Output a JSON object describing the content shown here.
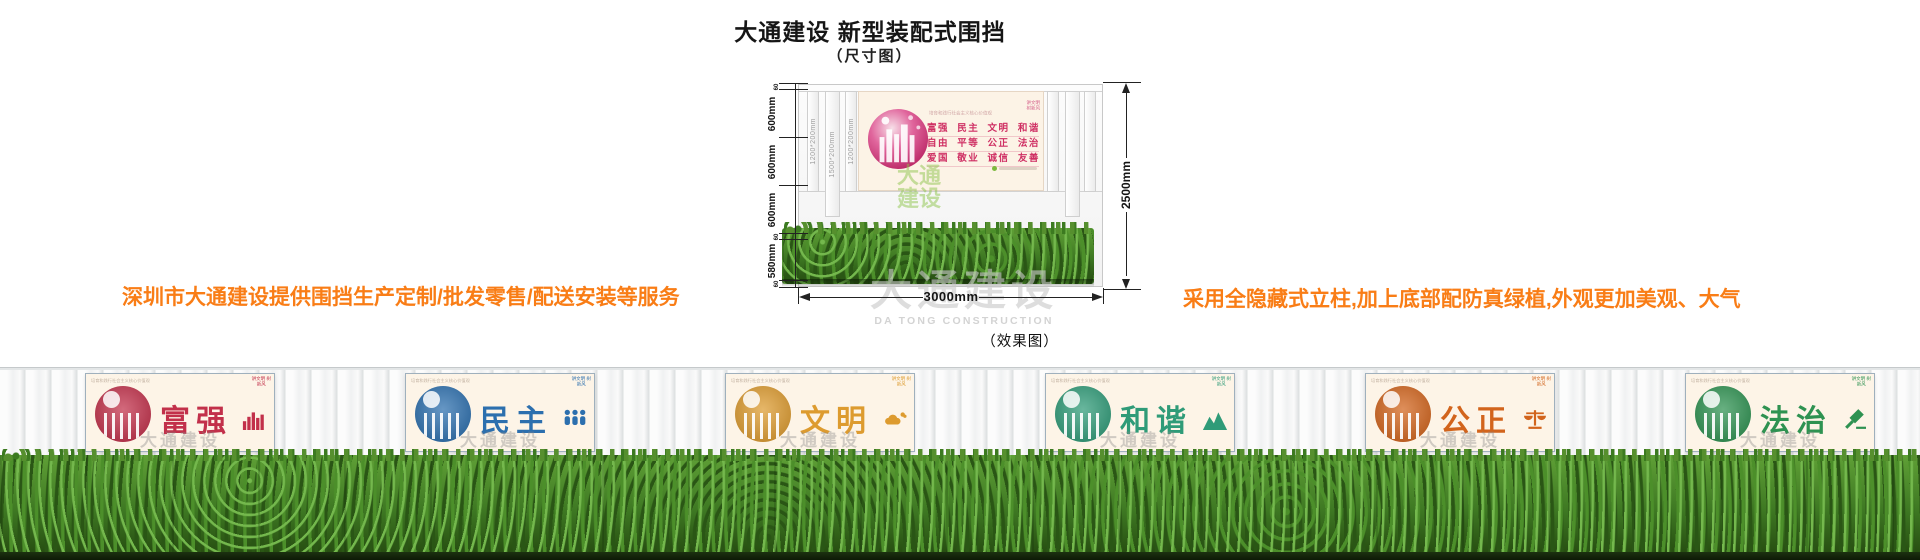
{
  "header": {
    "title": "大通建设 新型装配式围挡",
    "subtitle": "（尺寸图）"
  },
  "notes": {
    "left": "深圳市大通建设提供围挡生产定制/批发零售/配送安装等服务",
    "right": "采用全隐藏式立柱,加上底部配防真绿植,外观更加美观、大气",
    "color": "#f97d16"
  },
  "dimension_diagram": {
    "height_chain": [
      "60",
      "600mm",
      "600mm",
      "600mm",
      "60",
      "580mm",
      "60"
    ],
    "post_labels": [
      "1200*200mm",
      "1500*200mm",
      "1200*200mm"
    ],
    "total_height": "2500mm",
    "total_width": "3000mm",
    "panel": {
      "slogan_header": "培育和践行社会主义核心价值观",
      "corner_lines": [
        "讲文明",
        "树新风"
      ],
      "value_rows": [
        "富强  民主  文明  和谐",
        "自由  平等  公正  法治",
        "爱国  敬业  诚信  友善"
      ],
      "accent_color": "#cf2f63",
      "background_color": "#fcf3e6"
    },
    "green_watermark_lines": [
      "大通",
      "建设"
    ],
    "green_watermark_color": "#8bc34a"
  },
  "watermark": {
    "cn": "大通建设",
    "en": "DA TONG CONSTRUCTION"
  },
  "effect": {
    "label": "（效果图）",
    "panel_header": "培育和践行社会主义核心价值观",
    "panel_corner": "讲文明 树新风",
    "panel_watermark": "大通建设",
    "hedge_color": "#3f7d26",
    "panels": [
      {
        "name": "富强",
        "chars": "富强",
        "color": "#c2304a"
      },
      {
        "name": "民主",
        "chars": "民主",
        "color": "#2c6fae"
      },
      {
        "name": "文明",
        "chars": "文明",
        "color": "#dd9b2f"
      },
      {
        "name": "和谐",
        "chars": "和谐",
        "color": "#2f9b78"
      },
      {
        "name": "公正",
        "chars": "公正",
        "color": "#d2641c"
      },
      {
        "name": "法治",
        "chars": "法治",
        "color": "#2e9251"
      }
    ]
  }
}
